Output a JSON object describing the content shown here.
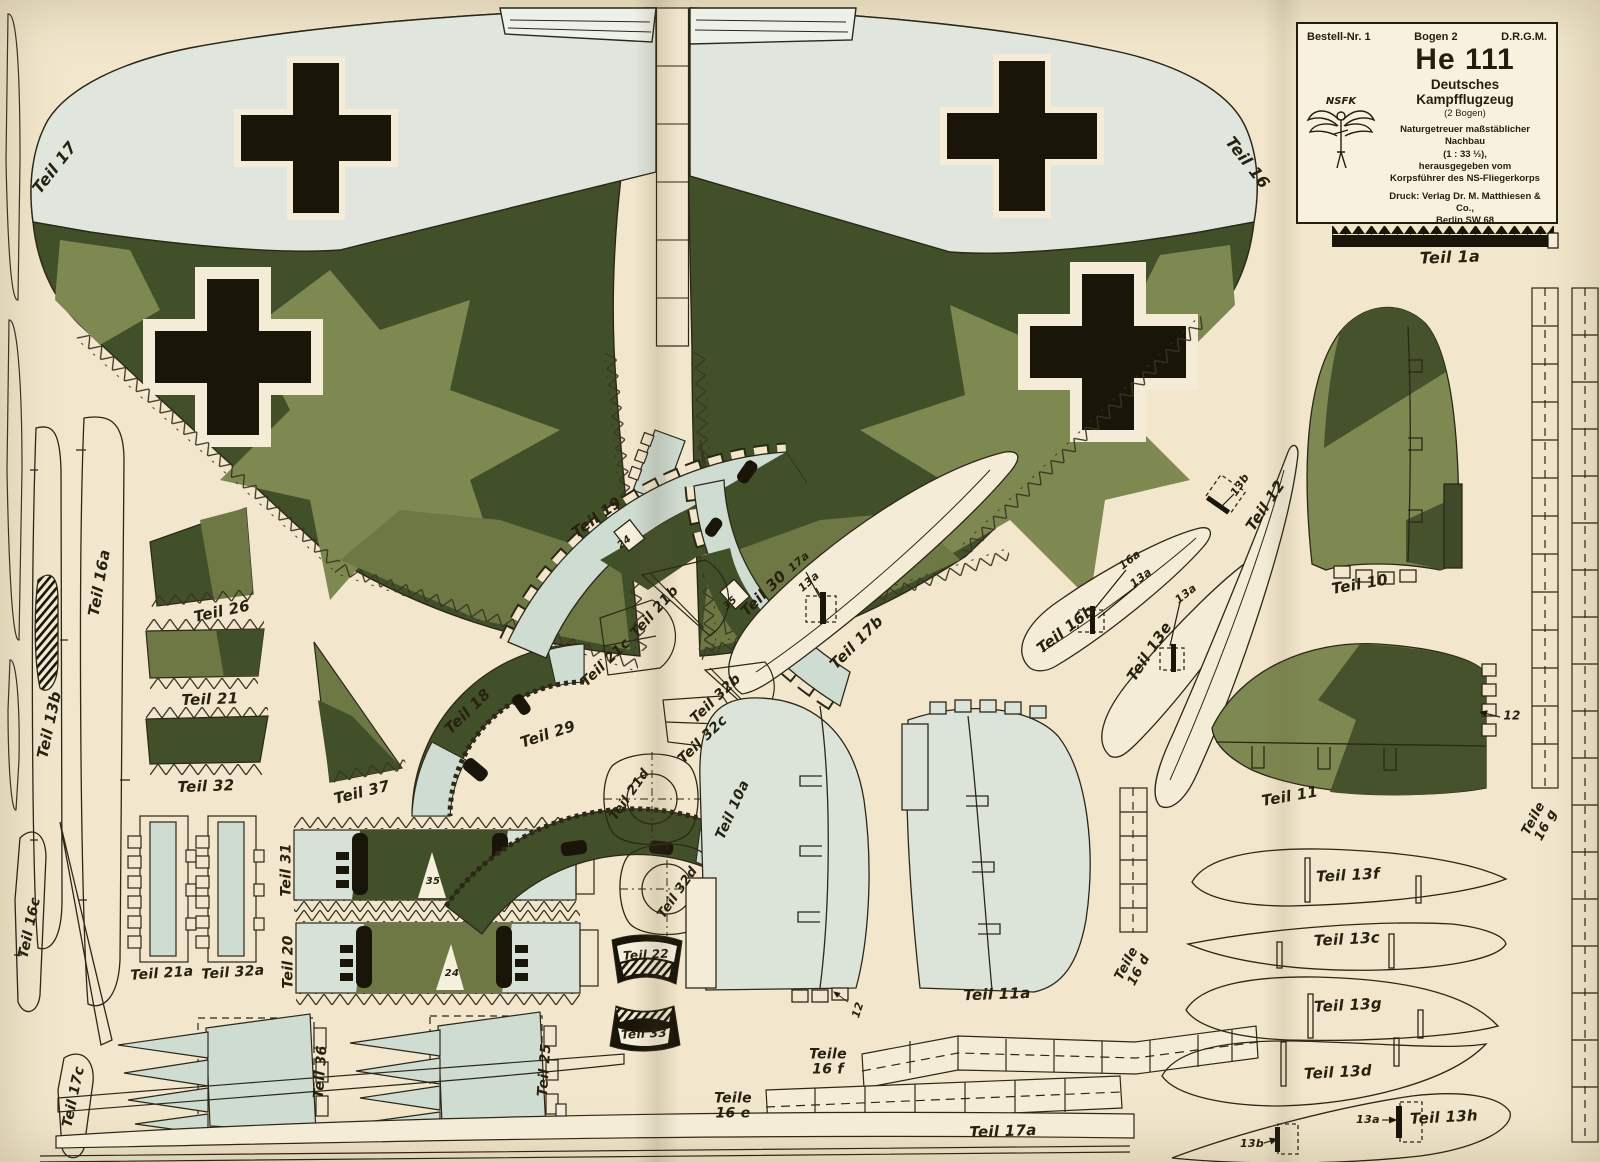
{
  "header": {
    "order_no": "Bestell-Nr. 1",
    "sheet_no": "Bogen 2",
    "drgm": "D.R.G.M.",
    "title": "He 111",
    "subtitle": "Deutsches Kampfflugzeug",
    "sheet_count": "(2 Bogen)",
    "desc1": "Naturgetreuer maßstäblicher Nachbau",
    "desc2": "(1 : 33 ⅓),",
    "desc3": "herausgegeben vom",
    "desc4": "Korpsführer des NS-Fliegerkorps",
    "printer1": "Druck: Verlag Dr. M. Matthiesen & Co.,",
    "printer2": "Berlin SW 68",
    "logo_text": "NSFK"
  },
  "colors": {
    "paper": "#f2e7cc",
    "paper_light": "#f7f1dd",
    "pale_wing": "#e0e6de",
    "pale_part": "#cfdcd2",
    "olive_dark": "#42502a",
    "olive_mid": "#6d7845",
    "olive_light": "#7e8851",
    "ink": "#26220f",
    "black": "#191509"
  },
  "labels": [
    {
      "t": "Teil 17",
      "x": 55,
      "y": 168,
      "r": -52,
      "s": 16
    },
    {
      "t": "Teil 16",
      "x": 1247,
      "y": 163,
      "r": 52,
      "s": 16
    },
    {
      "t": "Teil 16a",
      "x": 100,
      "y": 583,
      "r": -80,
      "s": 15
    },
    {
      "t": "Teil 13b",
      "x": 50,
      "y": 725,
      "r": -78,
      "s": 15
    },
    {
      "t": "Teil 26",
      "x": 222,
      "y": 612,
      "r": -12,
      "s": 15
    },
    {
      "t": "Teil 21",
      "x": 210,
      "y": 700,
      "r": -2,
      "s": 15
    },
    {
      "t": "Teil 32",
      "x": 206,
      "y": 787,
      "r": -2,
      "s": 15
    },
    {
      "t": "Teil 21a",
      "x": 162,
      "y": 974,
      "r": -4,
      "s": 14
    },
    {
      "t": "Teil 32a",
      "x": 233,
      "y": 973,
      "r": -4,
      "s": 14
    },
    {
      "t": "Teil 31",
      "x": 287,
      "y": 870,
      "r": -90,
      "s": 14
    },
    {
      "t": "Teil 20",
      "x": 289,
      "y": 962,
      "r": -90,
      "s": 14
    },
    {
      "t": "Teil 16c",
      "x": 30,
      "y": 928,
      "r": -78,
      "s": 14
    },
    {
      "t": "Teil 17c",
      "x": 74,
      "y": 1097,
      "r": -78,
      "s": 14
    },
    {
      "t": "Teil 36",
      "x": 321,
      "y": 1072,
      "r": -86,
      "s": 14
    },
    {
      "t": "Teil 25",
      "x": 545,
      "y": 1070,
      "r": -86,
      "s": 14
    },
    {
      "t": "Teil 37",
      "x": 362,
      "y": 793,
      "r": -14,
      "s": 15
    },
    {
      "t": "Teil 18",
      "x": 468,
      "y": 712,
      "r": -44,
      "s": 15
    },
    {
      "t": "Teil 29",
      "x": 548,
      "y": 735,
      "r": -18,
      "s": 15
    },
    {
      "t": "Teil 19",
      "x": 597,
      "y": 518,
      "r": -36,
      "s": 15
    },
    {
      "t": "Teil 21b",
      "x": 655,
      "y": 612,
      "r": -48,
      "s": 14
    },
    {
      "t": "Teil 21c",
      "x": 606,
      "y": 663,
      "r": -44,
      "s": 14
    },
    {
      "t": "Teil 30",
      "x": 764,
      "y": 594,
      "r": -45,
      "s": 15
    },
    {
      "t": "Teil 32b",
      "x": 716,
      "y": 699,
      "r": -44,
      "s": 14
    },
    {
      "t": "Teil 32c",
      "x": 703,
      "y": 740,
      "r": -44,
      "s": 14
    },
    {
      "t": "Teil 17b",
      "x": 857,
      "y": 643,
      "r": -45,
      "s": 15
    },
    {
      "t": "Teil 21d",
      "x": 630,
      "y": 795,
      "r": -55,
      "s": 13
    },
    {
      "t": "Teil 32d",
      "x": 678,
      "y": 893,
      "r": -55,
      "s": 13
    },
    {
      "t": "Teil 22",
      "x": 646,
      "y": 955,
      "r": -3,
      "s": 12
    },
    {
      "t": "Teil 33",
      "x": 644,
      "y": 1034,
      "r": -3,
      "s": 12
    },
    {
      "t": "Teil 10a",
      "x": 733,
      "y": 810,
      "r": -66,
      "s": 14
    },
    {
      "t": "Teil 11a",
      "x": 997,
      "y": 995,
      "r": -2,
      "s": 15
    },
    {
      "t": "Teile\n16 d",
      "x": 1133,
      "y": 967,
      "r": -62,
      "s": 13
    },
    {
      "t": "Teile\n16 f",
      "x": 828,
      "y": 1062,
      "r": 0,
      "s": 14
    },
    {
      "t": "Teile\n16 e",
      "x": 733,
      "y": 1106,
      "r": 0,
      "s": 14
    },
    {
      "t": "Teil 17a",
      "x": 1003,
      "y": 1132,
      "r": -2,
      "s": 15
    },
    {
      "t": "Teil 16b",
      "x": 1066,
      "y": 630,
      "r": -38,
      "s": 15
    },
    {
      "t": "Teil 13e",
      "x": 1150,
      "y": 652,
      "r": -56,
      "s": 15
    },
    {
      "t": "Teil 12",
      "x": 1266,
      "y": 506,
      "r": -56,
      "s": 15
    },
    {
      "t": "Teil 10",
      "x": 1360,
      "y": 585,
      "r": -10,
      "s": 15
    },
    {
      "t": "Teil 11",
      "x": 1290,
      "y": 797,
      "r": -10,
      "s": 15
    },
    {
      "t": "Teile\n16 g",
      "x": 1540,
      "y": 822,
      "r": -62,
      "s": 13
    },
    {
      "t": "Teil 13f",
      "x": 1348,
      "y": 876,
      "r": -3,
      "s": 15
    },
    {
      "t": "Teil 13c",
      "x": 1347,
      "y": 940,
      "r": -3,
      "s": 15
    },
    {
      "t": "Teil 13g",
      "x": 1348,
      "y": 1006,
      "r": -3,
      "s": 15
    },
    {
      "t": "Teil 13d",
      "x": 1338,
      "y": 1073,
      "r": -3,
      "s": 15
    },
    {
      "t": "Teil 13h",
      "x": 1444,
      "y": 1118,
      "r": -3,
      "s": 15
    },
    {
      "t": "Teil 1a",
      "x": 1450,
      "y": 258,
      "r": -2,
      "s": 16
    },
    {
      "t": "24",
      "x": 625,
      "y": 543,
      "r": -38,
      "s": 10
    },
    {
      "t": "35",
      "x": 731,
      "y": 604,
      "r": -42,
      "s": 10
    },
    {
      "t": "35",
      "x": 433,
      "y": 882,
      "r": 0,
      "s": 10
    },
    {
      "t": "24",
      "x": 452,
      "y": 974,
      "r": 0,
      "s": 10
    },
    {
      "t": "17a",
      "x": 799,
      "y": 562,
      "r": -42,
      "s": 11
    },
    {
      "t": "13a",
      "x": 809,
      "y": 582,
      "r": -42,
      "s": 11
    },
    {
      "t": "16a",
      "x": 1130,
      "y": 560,
      "r": -38,
      "s": 11
    },
    {
      "t": "13a",
      "x": 1141,
      "y": 578,
      "r": -38,
      "s": 11
    },
    {
      "t": "13a",
      "x": 1186,
      "y": 594,
      "r": -38,
      "s": 11
    },
    {
      "t": "13b",
      "x": 1240,
      "y": 485,
      "r": -56,
      "s": 11
    },
    {
      "t": "12",
      "x": 1512,
      "y": 716,
      "r": 0,
      "s": 12
    },
    {
      "t": "12",
      "x": 858,
      "y": 1010,
      "r": -72,
      "s": 11
    },
    {
      "t": "13a",
      "x": 1368,
      "y": 1120,
      "r": 0,
      "s": 11
    },
    {
      "t": "13b",
      "x": 1252,
      "y": 1144,
      "r": 0,
      "s": 11
    }
  ]
}
